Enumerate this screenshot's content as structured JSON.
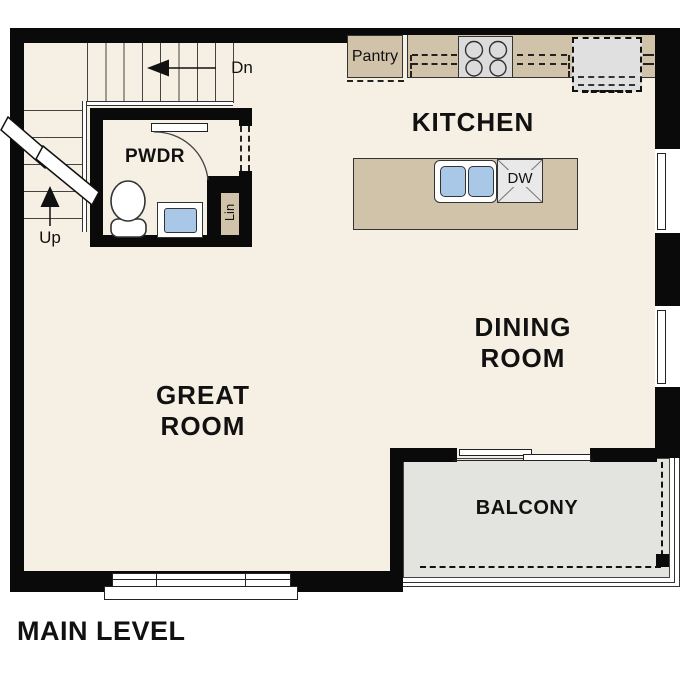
{
  "page": {
    "title": "MAIN LEVEL"
  },
  "rooms": {
    "kitchen": {
      "label": "KITCHEN"
    },
    "dining_room": {
      "line1": "DINING",
      "line2": "ROOM"
    },
    "great_room": {
      "line1": "GREAT",
      "line2": "ROOM"
    },
    "balcony": {
      "label": "BALCONY"
    },
    "powder_room": {
      "label": "PWDR"
    }
  },
  "closets": {
    "pantry": {
      "label": "Pantry"
    },
    "linen": {
      "label": "Lin"
    }
  },
  "stairs": {
    "down_label": "Dn",
    "up_label": "Up"
  },
  "appliances": {
    "dishwasher_label": "DW"
  },
  "colors": {
    "wall": "#0a0a0a",
    "floor": "#f6efe3",
    "cabinetry": "#d1c3a9",
    "appliance_gray": "#dcdcdc",
    "balcony_floor": "#e3e3e0",
    "sink_blue": "#a9c8e8"
  }
}
